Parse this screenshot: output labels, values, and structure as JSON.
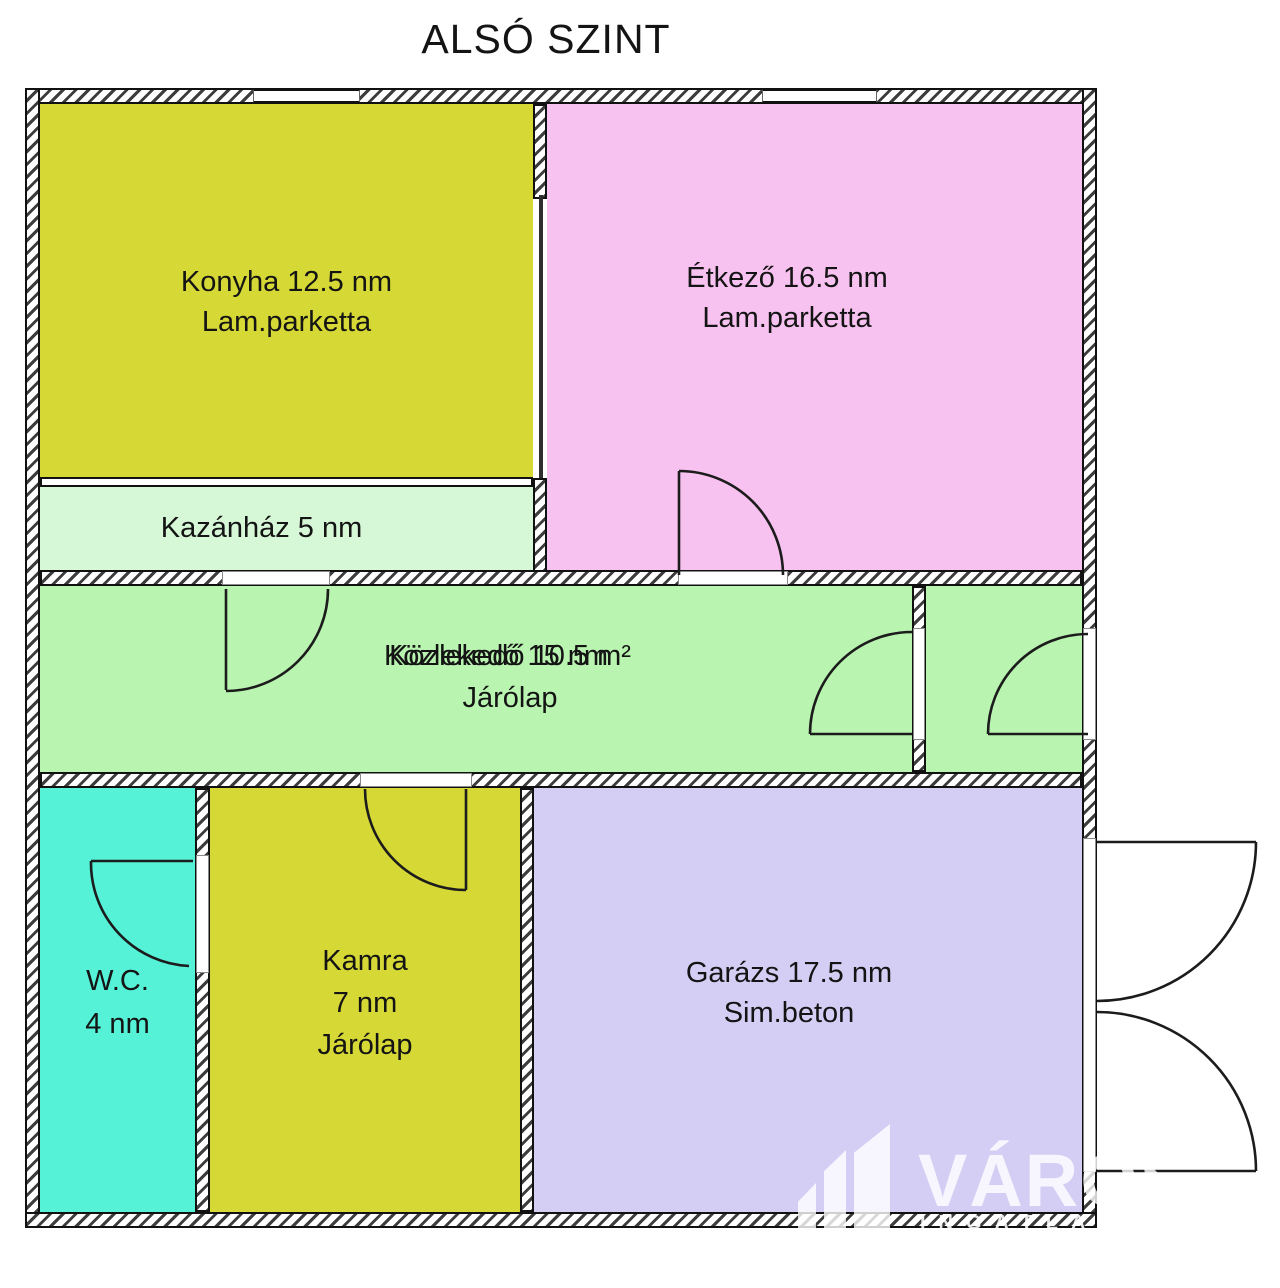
{
  "title": "ALSÓ SZINT",
  "floorplan": {
    "rooms": {
      "konyha": {
        "name_area": "Konyha 12.5 nm",
        "flooring": "Lam.parketta",
        "color": "#d6d835"
      },
      "etkezo": {
        "name_area": "Étkező 16.5 nm",
        "flooring": "Lam.parketta",
        "color": "#f8c2f0"
      },
      "kazanhaz": {
        "name_area": "Kazánház 5 nm",
        "color": "#d6f8d6"
      },
      "kozlekedo": {
        "name_area": "Közlekedő 15 nm",
        "name_area_overlap": "Közlekedő 10.5 m²",
        "flooring": "Járólap",
        "color": "#b9f4b1"
      },
      "kozlekedo_cell": {
        "color": "#b9f4b1"
      },
      "wc": {
        "name": "W.C.",
        "area": "4 nm",
        "color": "#55f2d8"
      },
      "kamra": {
        "name": "Kamra",
        "area": "7 nm",
        "flooring": "Járólap",
        "color": "#d6d835"
      },
      "garazs": {
        "name_area": "Garázs 17.5 nm",
        "flooring": "Sim.beton",
        "color": "#d5cef4"
      }
    },
    "wall_hatch_color": "#3d3d3d",
    "outline_color": "#111111"
  },
  "watermark": {
    "brand": "VÁROS",
    "subtext": "INGATLAN"
  }
}
